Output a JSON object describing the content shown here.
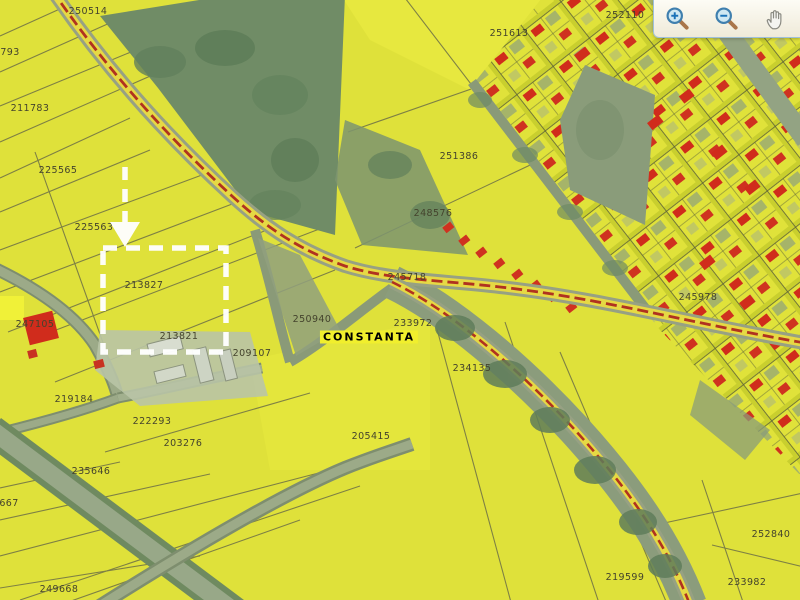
{
  "map": {
    "place_label": "CONSTANTA",
    "parcel_labels": [
      {
        "text": "250514",
        "x": 88,
        "y": 14
      },
      {
        "text": "793",
        "x": 10,
        "y": 55
      },
      {
        "text": "211783",
        "x": 30,
        "y": 111
      },
      {
        "text": "225565",
        "x": 58,
        "y": 173
      },
      {
        "text": "225563",
        "x": 94,
        "y": 230
      },
      {
        "text": "251613",
        "x": 509,
        "y": 36
      },
      {
        "text": "252110",
        "x": 625,
        "y": 18
      },
      {
        "text": "251386",
        "x": 459,
        "y": 159
      },
      {
        "text": "248576",
        "x": 433,
        "y": 216
      },
      {
        "text": "245718",
        "x": 407,
        "y": 280
      },
      {
        "text": "245978",
        "x": 698,
        "y": 300
      },
      {
        "text": "213827",
        "x": 144,
        "y": 288
      },
      {
        "text": "213821",
        "x": 179,
        "y": 339
      },
      {
        "text": "247105",
        "x": 35,
        "y": 327
      },
      {
        "text": "250940",
        "x": 312,
        "y": 322
      },
      {
        "text": "233972",
        "x": 413,
        "y": 326
      },
      {
        "text": "209107",
        "x": 252,
        "y": 356
      },
      {
        "text": "234135",
        "x": 472,
        "y": 371
      },
      {
        "text": "219184",
        "x": 74,
        "y": 402
      },
      {
        "text": "222293",
        "x": 152,
        "y": 424
      },
      {
        "text": "203276",
        "x": 183,
        "y": 446
      },
      {
        "text": "205415",
        "x": 371,
        "y": 439
      },
      {
        "text": "235646",
        "x": 91,
        "y": 474
      },
      {
        "text": "667",
        "x": 9,
        "y": 506
      },
      {
        "text": "249668",
        "x": 59,
        "y": 592
      },
      {
        "text": "219599",
        "x": 625,
        "y": 580
      },
      {
        "text": "233982",
        "x": 747,
        "y": 585
      },
      {
        "text": "252840",
        "x": 771,
        "y": 537
      }
    ],
    "selection": {
      "box": {
        "x": 103,
        "y": 248,
        "width": 123,
        "height": 104
      },
      "arrow": {
        "x": 125,
        "y1": 167,
        "y2": 222,
        "head_tip_y": 247,
        "head_half_width": 15
      },
      "color": "#ffffff"
    },
    "colors": {
      "parcel_yellow": "#dfe13a",
      "building_red": "#d02c1c",
      "road_gray": "#98a888",
      "green_area": "#708c66",
      "highway_fill": "#e6d944",
      "highway_centerline": "#b03220",
      "label_text": "#44432d"
    }
  },
  "toolbar": {
    "tools": [
      {
        "id": "zoom-in",
        "icon": "zoom-in-icon"
      },
      {
        "id": "zoom-out",
        "icon": "zoom-out-icon"
      },
      {
        "id": "pan",
        "icon": "hand-icon"
      }
    ]
  }
}
